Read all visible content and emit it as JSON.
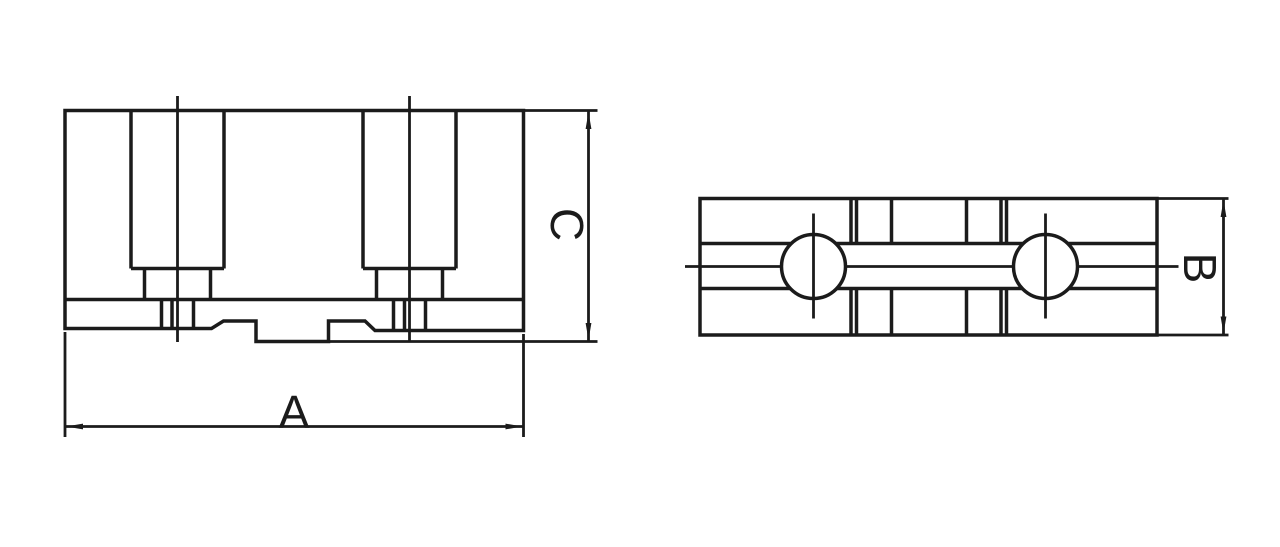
{
  "drawing": {
    "background": "#ffffff",
    "ink": "#1b1b1b",
    "dimensions": {
      "a": {
        "label": "A",
        "orientation": "horizontal",
        "view": "front"
      },
      "b": {
        "label": "B",
        "orientation": "vertical",
        "view": "top"
      },
      "c": {
        "label": "C",
        "orientation": "vertical",
        "view": "front"
      }
    },
    "views": {
      "front": {
        "id": "front-view",
        "mounting_slots": 2,
        "center_lines": 2
      },
      "top": {
        "id": "top-view",
        "holes": 2,
        "center_lines": 3
      }
    }
  }
}
